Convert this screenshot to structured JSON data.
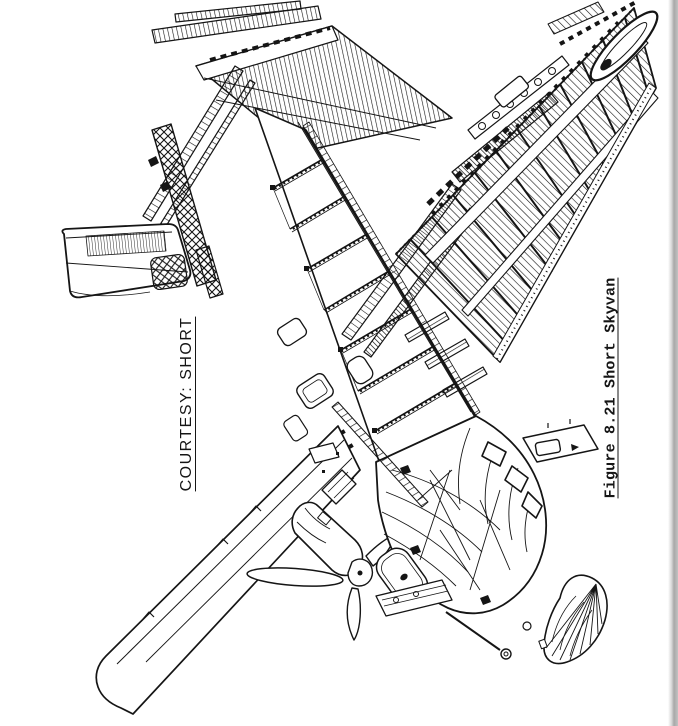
{
  "page": {
    "background_color": "#ffffff",
    "ink_color": "#151515",
    "page_edge_color": "#a8a8a8"
  },
  "labels": {
    "courtesy": "COURTESY: SHORT",
    "caption": "Figure 8.21 Short Skyvan"
  },
  "illustration": {
    "name": "short-skyvan-cutaway-drawing",
    "alt": "Short Skyvan"
  }
}
